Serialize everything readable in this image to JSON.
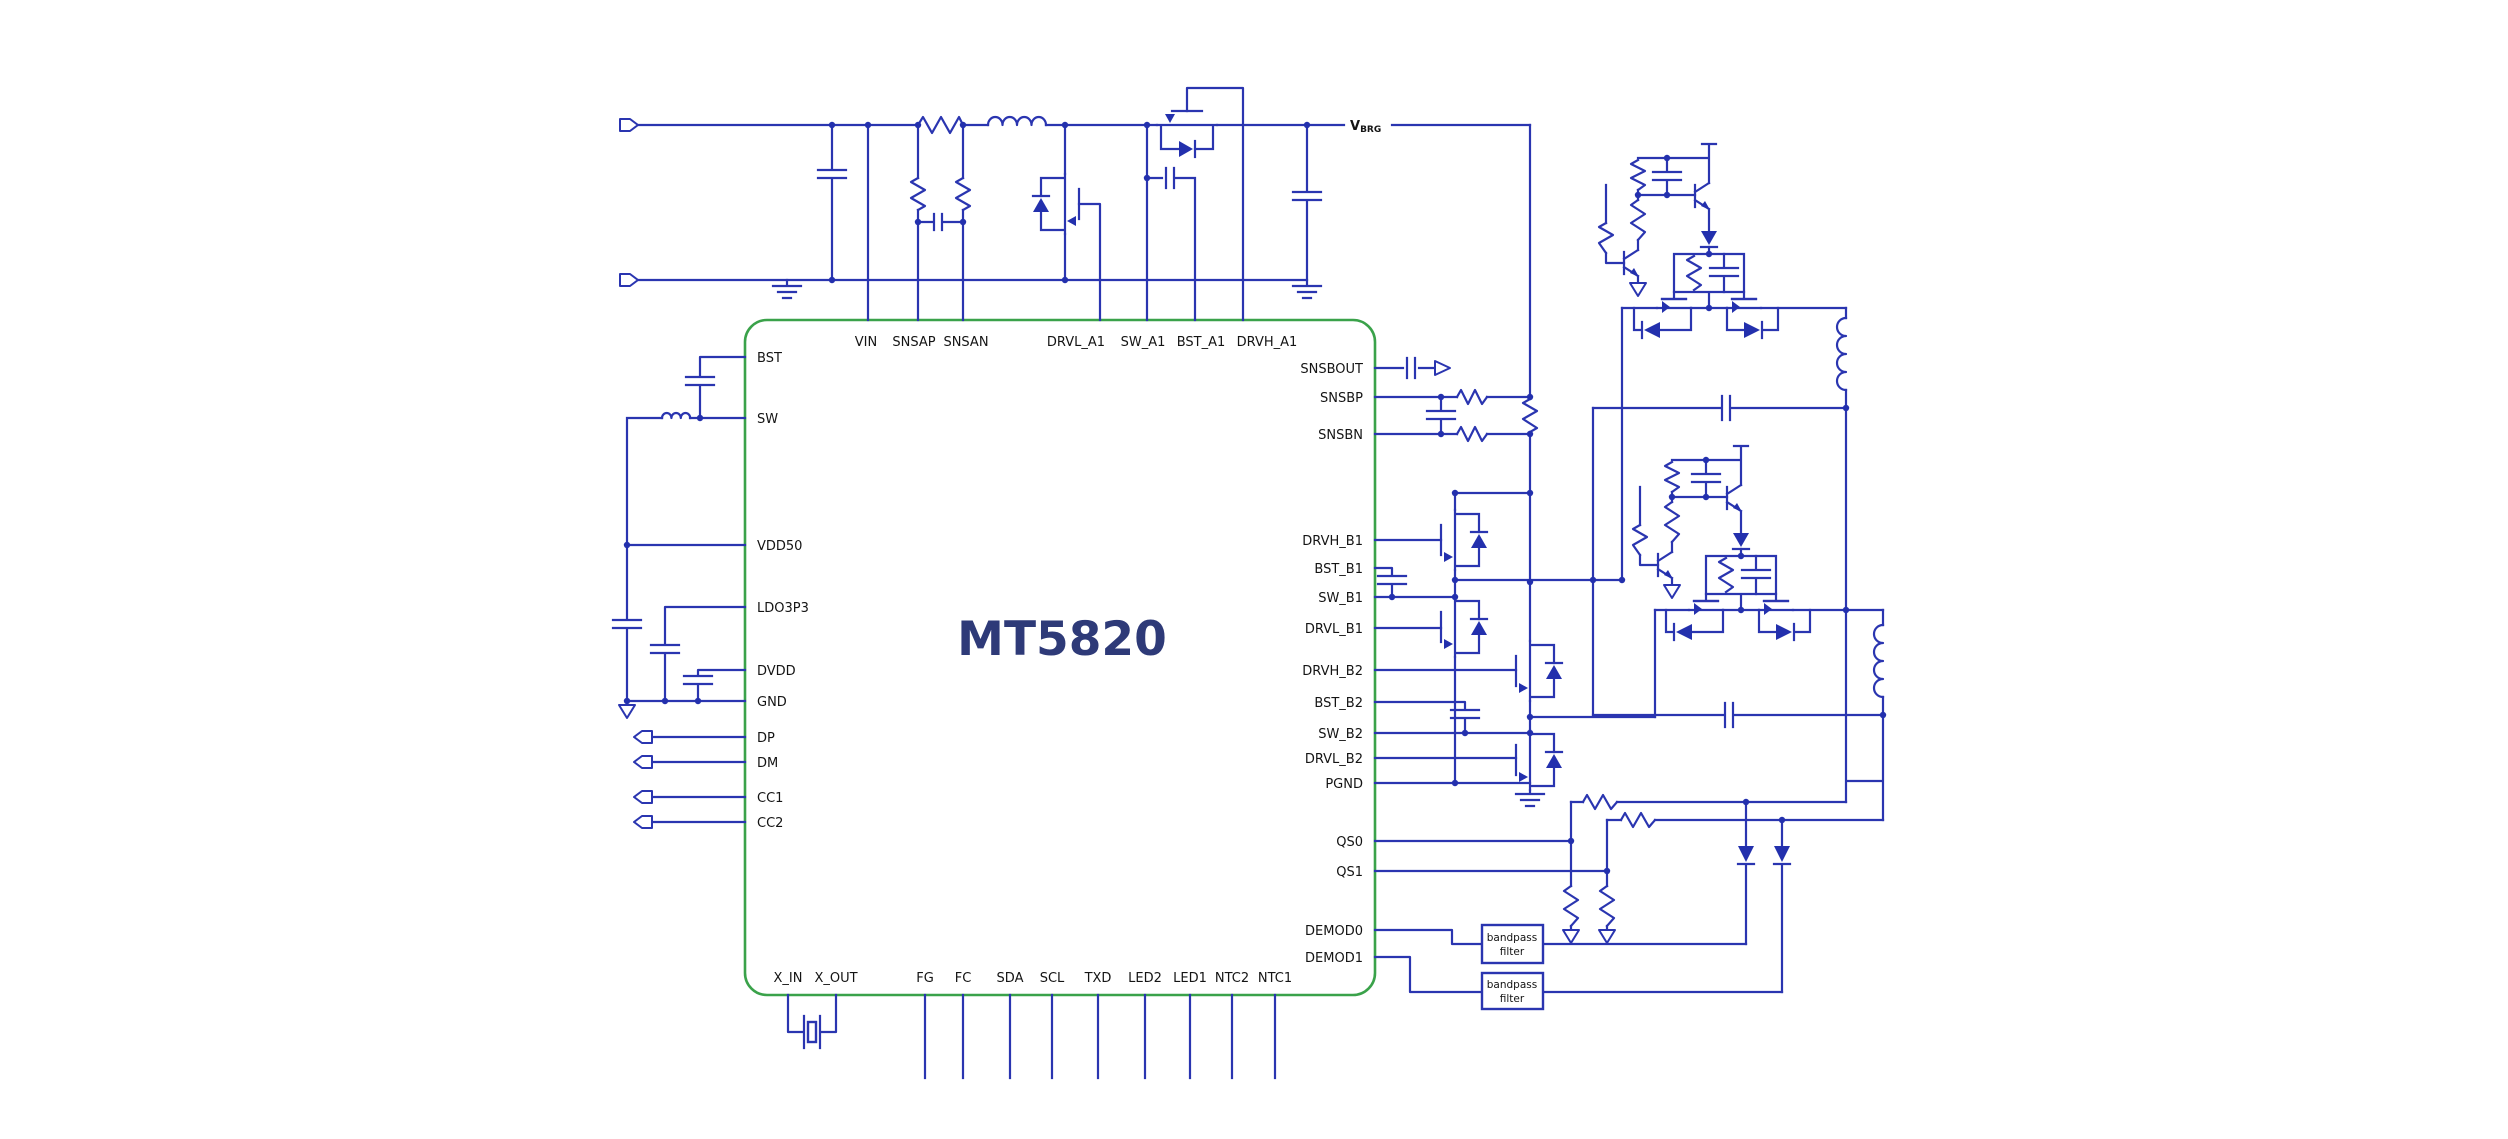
{
  "ic": {
    "name": "MT5820",
    "pins": {
      "top": [
        "VIN",
        "SNSAP",
        "SNSAN",
        "DRVL_A1",
        "SW_A1",
        "BST_A1",
        "DRVH_A1"
      ],
      "left": [
        "BST",
        "SW",
        "VDD50",
        "LDO3P3",
        "DVDD",
        "GND",
        "DP",
        "DM",
        "CC1",
        "CC2"
      ],
      "right": [
        "SNSBOUT",
        "SNSBP",
        "SNSBN",
        "DRVH_B1",
        "BST_B1",
        "SW_B1",
        "DRVL_B1",
        "DRVH_B2",
        "BST_B2",
        "SW_B2",
        "DRVL_B2",
        "PGND",
        "QS0",
        "QS1",
        "DEMOD0",
        "DEMOD1"
      ],
      "bottom": [
        "X_IN",
        "X_OUT",
        "FG",
        "FC",
        "SDA",
        "SCL",
        "TXD",
        "LED2",
        "LED1",
        "NTC2",
        "NTC1"
      ]
    }
  },
  "nets": {
    "vbrg_main": "V",
    "vbrg_sub": "BRG"
  },
  "blocks": {
    "bandpass_filter_1": {
      "line1": "bandpass",
      "line2": "filter"
    },
    "bandpass_filter_2": {
      "line1": "bandpass",
      "line2": "filter"
    }
  },
  "colors": {
    "wire": "#2a35b0",
    "ic_outline": "#3aa24a",
    "ic_label": "#2e3a78",
    "label": "#141414",
    "background": "#ffffff"
  }
}
